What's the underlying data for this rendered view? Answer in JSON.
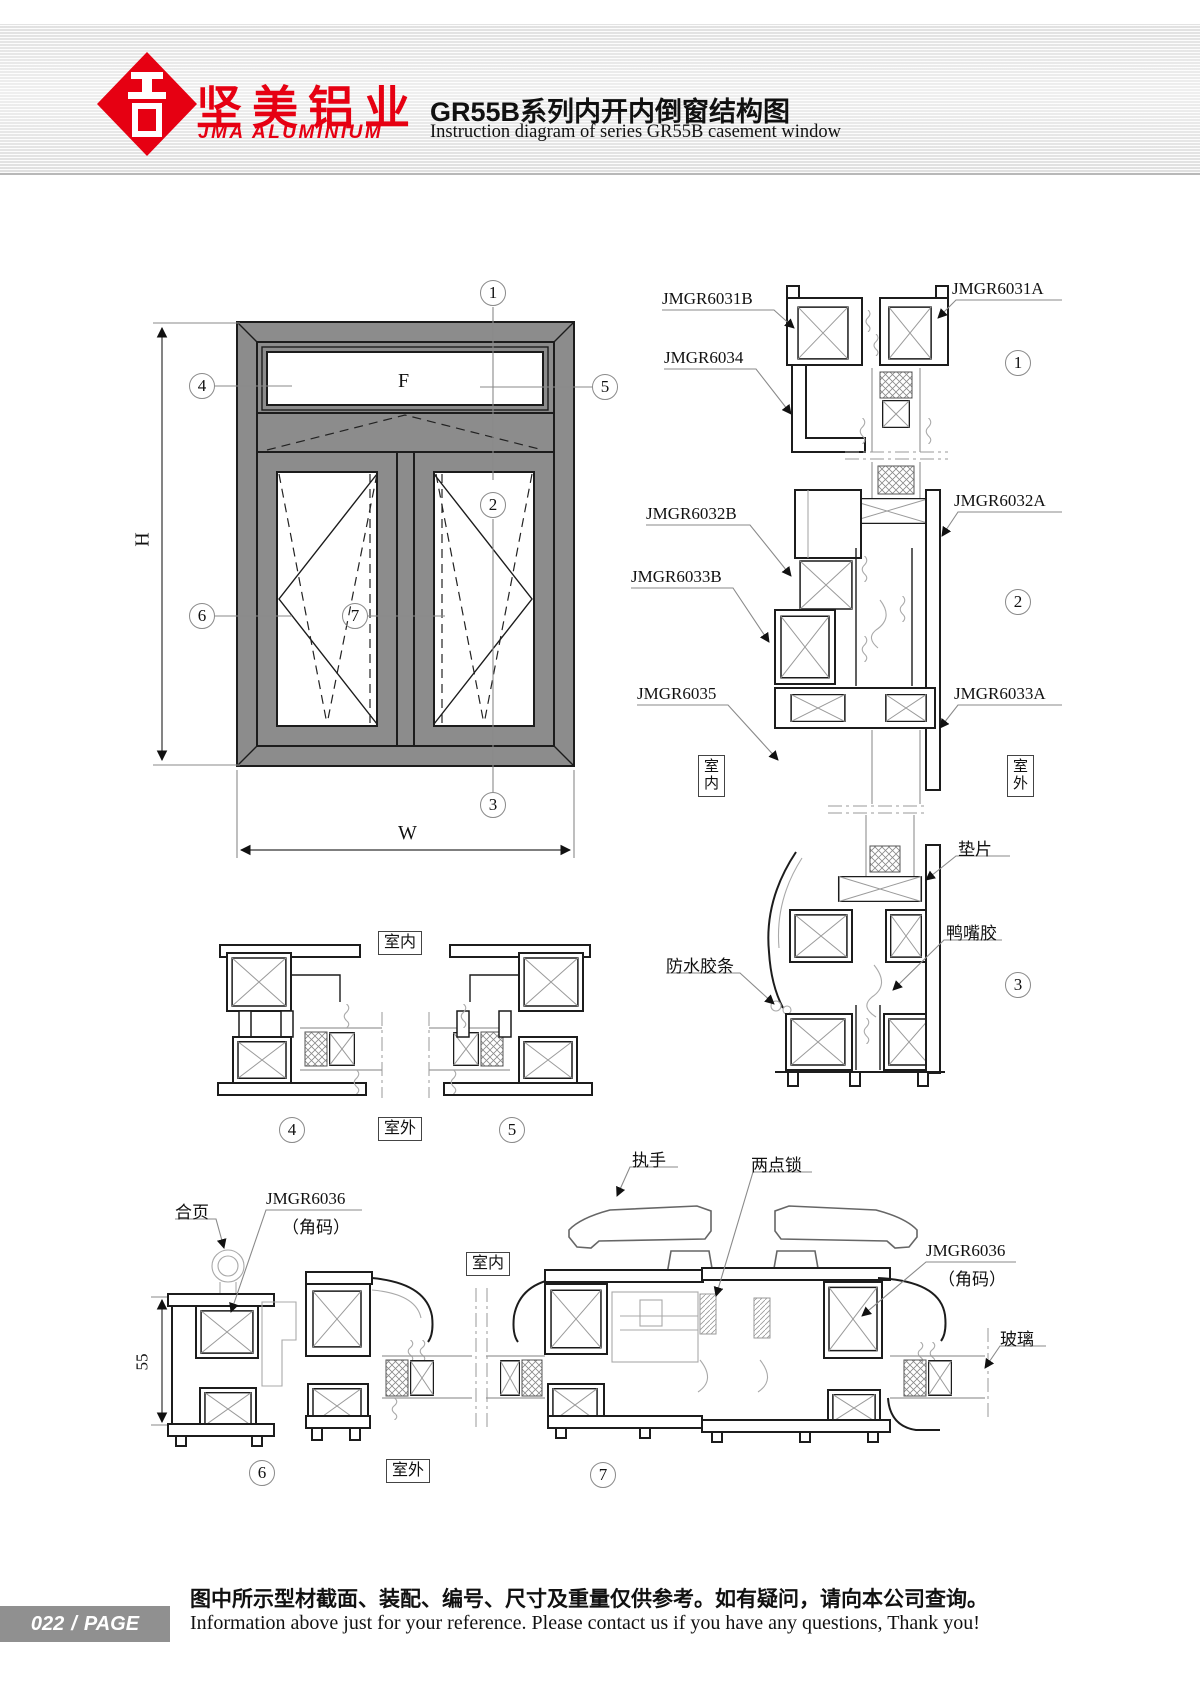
{
  "header": {
    "brand_cn": "坚美铝业",
    "brand_en": "JMA ALUMINIUM",
    "title_cn": "GR55B系列内开内倒窗结构图",
    "title_en": "Instruction diagram of series GR55B casement window",
    "brand_color": "#e60012"
  },
  "window_elevation": {
    "height_dim": "H",
    "width_dim": "W",
    "fixed_panel": "F"
  },
  "section_callouts": {
    "n1": "1",
    "n2": "2",
    "n3": "3",
    "n4": "4",
    "n5": "5",
    "n6": "6",
    "n7": "7"
  },
  "position_labels": {
    "indoor": "室内",
    "outdoor": "室外"
  },
  "part_labels": {
    "s1_frame_b": "JMGR6031B",
    "s1_frame_a": "JMGR6031A",
    "s1_glazing_bead": "JMGR6034",
    "s2_sash_b": "JMGR6032B",
    "s2_sash_a": "JMGR6032A",
    "s2_frame_b": "JMGR6033B",
    "s2_cover": "JMGR6035",
    "s2_frame_a": "JMGR6033A",
    "gasket": "垫片",
    "duckbill_rubber": "鸭嘴胶",
    "waterproof_strip": "防水胶条",
    "hinge": "合页",
    "corner_code": "JMGR6036",
    "corner_code_sub": "（角码）",
    "handle": "执手",
    "two_point_lock": "两点锁",
    "glass": "玻璃"
  },
  "dimensions": {
    "frame_depth": "55"
  },
  "footer": {
    "page_number": "022",
    "page_separator": "/",
    "page_label": "PAGE",
    "note_cn": "图中所示型材截面、装配、编号、尺寸及重量仅供参考。如有疑问，请向本公司查询。",
    "note_en": "Information above just for your reference. Please contact us if you have any questions, Thank you!"
  }
}
